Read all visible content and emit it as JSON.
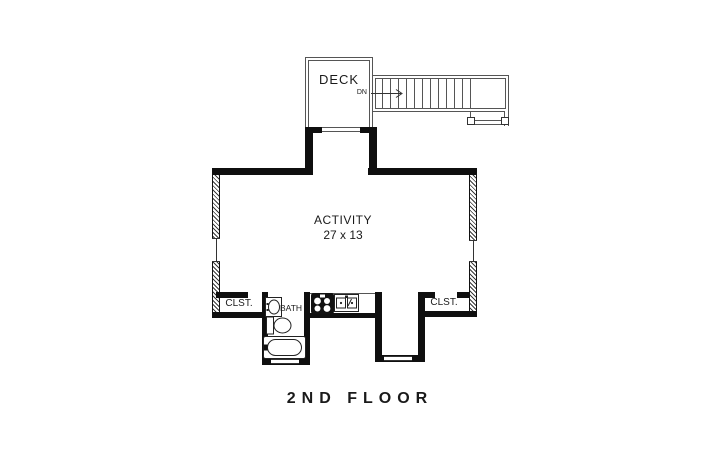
{
  "plan_title": "2ND FLOOR",
  "labels": {
    "deck": "DECK",
    "down": "DN",
    "activity": "ACTIVITY",
    "activity_dimensions": "27 x 13",
    "closet_left": "CLST.",
    "closet_right": "CLST.",
    "bath": "BATH"
  },
  "stairs": {
    "tread_count": 12,
    "direction": "down from deck to landing"
  },
  "icons": {
    "dn_arrow": "arrow from DN label pointing right into stair run",
    "bath_sink": "vanity counter with oval basin",
    "toilet": "toilet with tank against west wall, bowl facing right",
    "bathtub": "bathtub with faucet at left end",
    "cooktop": "four-burner cooktop",
    "kitchen_sink": "double-basin sink with faucet"
  },
  "colors": {
    "background": "#ffffff",
    "wall": "#0f0f0f",
    "thin_line": "#555555",
    "text": "#1a1a1a"
  }
}
